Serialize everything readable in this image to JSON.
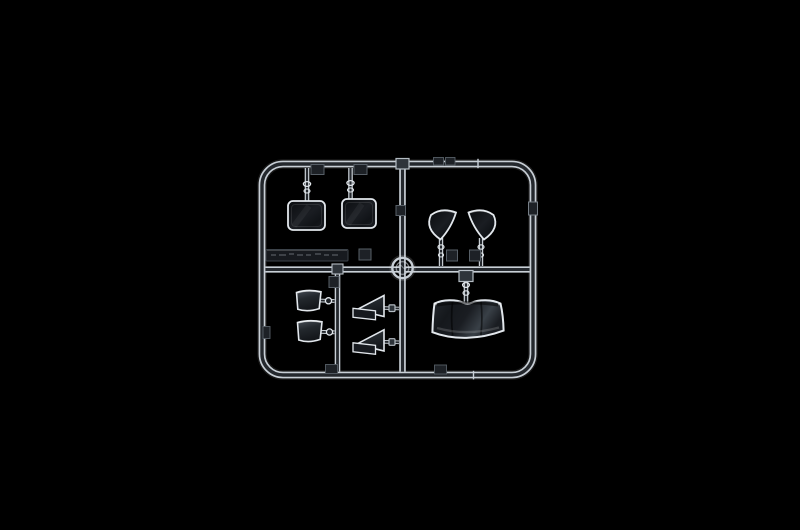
{
  "meta": {
    "type": "product-photograph",
    "subject": "Clear transparent plastic model-kit sprue (injection-moulded parts tree) holding window glazing parts, photographed on a solid black background",
    "visible_text": "none - embossed lettering on the small moulded plate is too small to read",
    "lighting": "dark-field lighting: only part edges and runner highlights catch the light"
  },
  "palette": {
    "background": "#000000",
    "runnerEdge": "#c8cfd6",
    "runnerCore": "#24282d",
    "stemEdge": "#ccd3d9",
    "partStroke": "#e2e7ec",
    "glassDeepA": "#0a0c0f",
    "glassDeepB": "#1a1d22",
    "glassDeepC": "#101317",
    "glassLightA": "#474d55",
    "glassLightB": "#23282d",
    "glassLightC": "#13161a",
    "shieldA": "#23272c",
    "shieldB": "#15181c",
    "shieldC": "#394047",
    "shieldD": "#1a1d22",
    "plateFill": "#171a1f",
    "plateStroke": "#3c434a",
    "tabFill": "#1d2126",
    "tabStroke": "#767e86",
    "tabStrokeDim": "#575f67",
    "brightTabFill": "#2e343a",
    "brightTabStroke": "#b4bcc3",
    "medallionFill": "#0e1114",
    "emboss": "rgba(195,205,215,0.3)"
  },
  "parts": [
    {
      "id": "sprue-frame",
      "desc": "rounded rectangular outer runner frame"
    },
    {
      "id": "horizontal-runner",
      "desc": "middle horizontal runner"
    },
    {
      "id": "vertical-runner-main",
      "desc": "full-height vertical runner"
    },
    {
      "id": "vertical-runner-inner",
      "desc": "short vertical runner in lower-left bay"
    },
    {
      "id": "mold-medallion",
      "desc": "round moulded medallion at runner crossing"
    },
    {
      "id": "molded-text-plate",
      "desc": "dark plate with embossed illegible lettering"
    },
    {
      "id": "rear-window-left",
      "desc": "rectangular clear window part"
    },
    {
      "id": "rear-window-right",
      "desc": "rectangular clear window part"
    },
    {
      "id": "quarter-light-left",
      "desc": "curved triangular quarter window"
    },
    {
      "id": "quarter-light-right",
      "desc": "curved triangular quarter window"
    },
    {
      "id": "side-glass-upper",
      "desc": "small curved side window"
    },
    {
      "id": "side-glass-lower",
      "desc": "small curved side window"
    },
    {
      "id": "vent-window-upper",
      "desc": "triangular vent window with flange"
    },
    {
      "id": "vent-window-lower",
      "desc": "triangular vent window with flange"
    },
    {
      "id": "windscreen",
      "desc": "large curved windscreen part"
    }
  ]
}
